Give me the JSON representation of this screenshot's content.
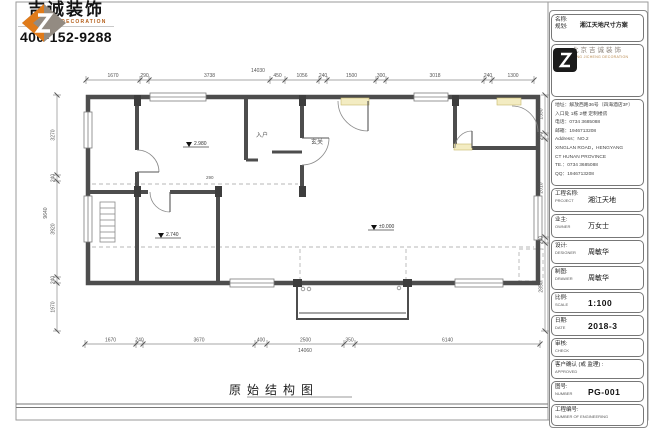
{
  "header": {
    "brand_cn": "吉诚装饰",
    "brand_en": "JI CHENG DECORATION",
    "phone": "400-152-9288"
  },
  "drawing": {
    "title": "原始结构图",
    "overall_top": "14030",
    "overall_bottom": "14060",
    "overall_left": "9640",
    "dims_top": [
      "1670",
      "290",
      "3738",
      "450",
      "1056",
      "240",
      "1500",
      "300",
      "3018",
      "240",
      "1300"
    ],
    "dims_bottom": [
      "1670",
      "240",
      "3670",
      "400",
      "2500",
      "350",
      "6140"
    ],
    "dims_left": [
      "3270",
      "240",
      "3920",
      "240",
      "1970"
    ],
    "dims_right": [
      "1590",
      "240",
      "2010",
      "240",
      "2850"
    ],
    "levels": [
      "2.980",
      "2.740",
      "±0.000"
    ],
    "rooms": {
      "entry": "入户",
      "foyer": "玄关"
    },
    "inner_dims": [
      "290"
    ]
  },
  "title_block": {
    "name_label_1": "名称:",
    "name_label_2": "规划:",
    "name_value": "湘江天地尺寸方案",
    "company_cn": "北京吉诚装饰",
    "company_en": "BEIJING JICHENG DECORATION",
    "address_lines": [
      "地址：解放西路36号（四海酒店3F）",
      "入口处 1栋 2楼 定制楼房",
      "电话：0734 3685088",
      "邮箱：1946713208",
      "Address：NO.2",
      "XINGLAN ROAD，HENGYANG",
      "CT HUNAN PROVINCE",
      "TE.：0734 3685088",
      "QQ：1946713208"
    ],
    "rows": [
      {
        "cn": "工程名称:",
        "en": "PROJECT",
        "value": "湘江天地"
      },
      {
        "cn": "业主:",
        "en": "OWNER",
        "value": "万女士"
      },
      {
        "cn": "设计:",
        "en": "DESIGNER",
        "value": "周敏华"
      },
      {
        "cn": "制图:",
        "en": "DRAWER",
        "value": "周敏华"
      },
      {
        "cn": "比例:",
        "en": "SCALE",
        "value": "1:100"
      },
      {
        "cn": "日期:",
        "en": "DATE",
        "value": "2018-3"
      },
      {
        "cn": "审核:",
        "en": "CHECK",
        "value": ""
      },
      {
        "cn": "客户确认 (或 监理) :",
        "en": "APPROVED",
        "value": ""
      },
      {
        "cn": "图号:",
        "en": "NUMBER",
        "value": "PG-001"
      },
      {
        "cn": "工程编号:",
        "en": "NUMBER OF ENGINEERING",
        "value": ""
      }
    ]
  }
}
